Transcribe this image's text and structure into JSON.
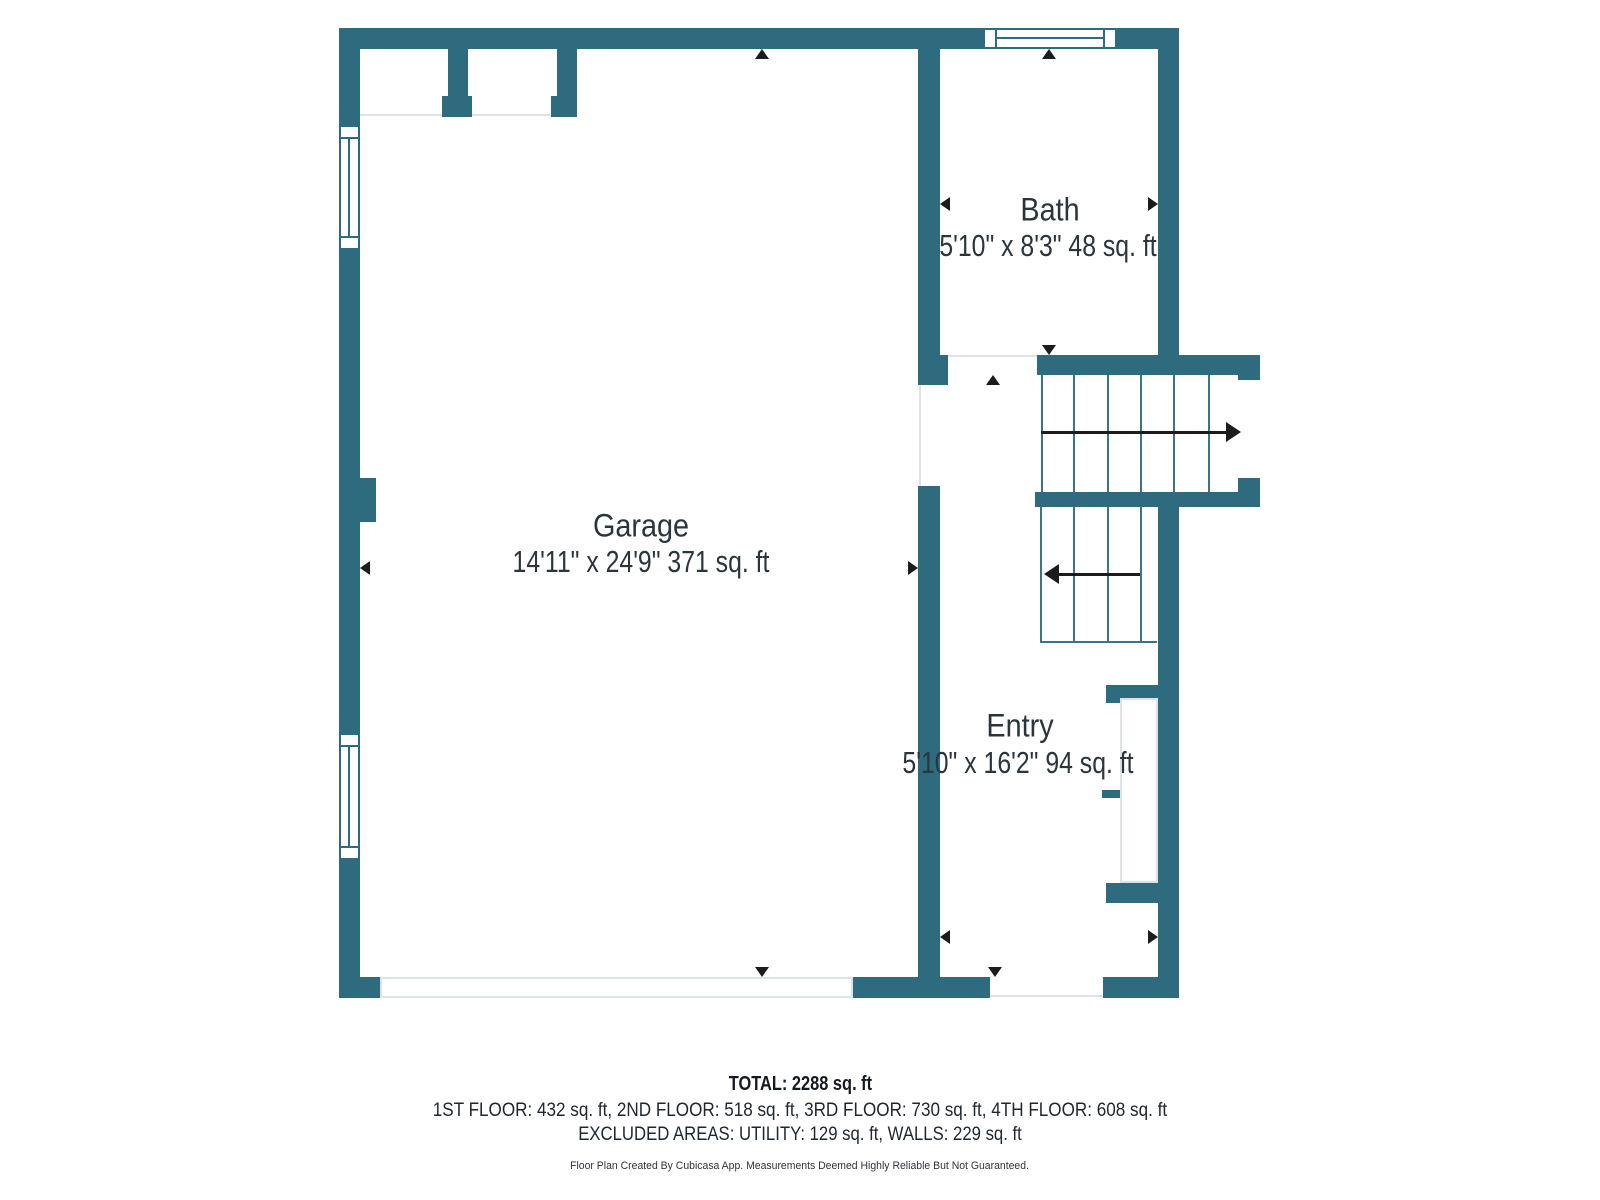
{
  "colors": {
    "wall": "#2e6b7e",
    "stair_line": "#3c7487",
    "light_line": "#dde2e5",
    "label_text": "#2a353c",
    "marker": "#1c1c1c"
  },
  "rooms": [
    {
      "name": "Garage",
      "dims": "14'11\" x 24'9\" 371 sq. ft"
    },
    {
      "name": "Bath",
      "dims": "5'10\" x 8'3\" 48 sq. ft"
    },
    {
      "name": "Entry",
      "dims": "5'10\" x 16'2\" 94 sq. ft"
    }
  ],
  "stairs": {
    "upper_run_direction": "right",
    "lower_run_direction": "left"
  },
  "summary": {
    "total": "TOTAL: 2288 sq. ft",
    "floors": "1ST FLOOR: 432 sq. ft, 2ND FLOOR: 518 sq. ft, 3RD FLOOR: 730 sq. ft, 4TH FLOOR: 608 sq. ft",
    "excluded": "EXCLUDED AREAS: UTILITY: 129 sq. ft, WALLS: 229 sq. ft",
    "credit": "Floor Plan Created By Cubicasa App. Measurements Deemed Highly Reliable But Not Guaranteed."
  }
}
